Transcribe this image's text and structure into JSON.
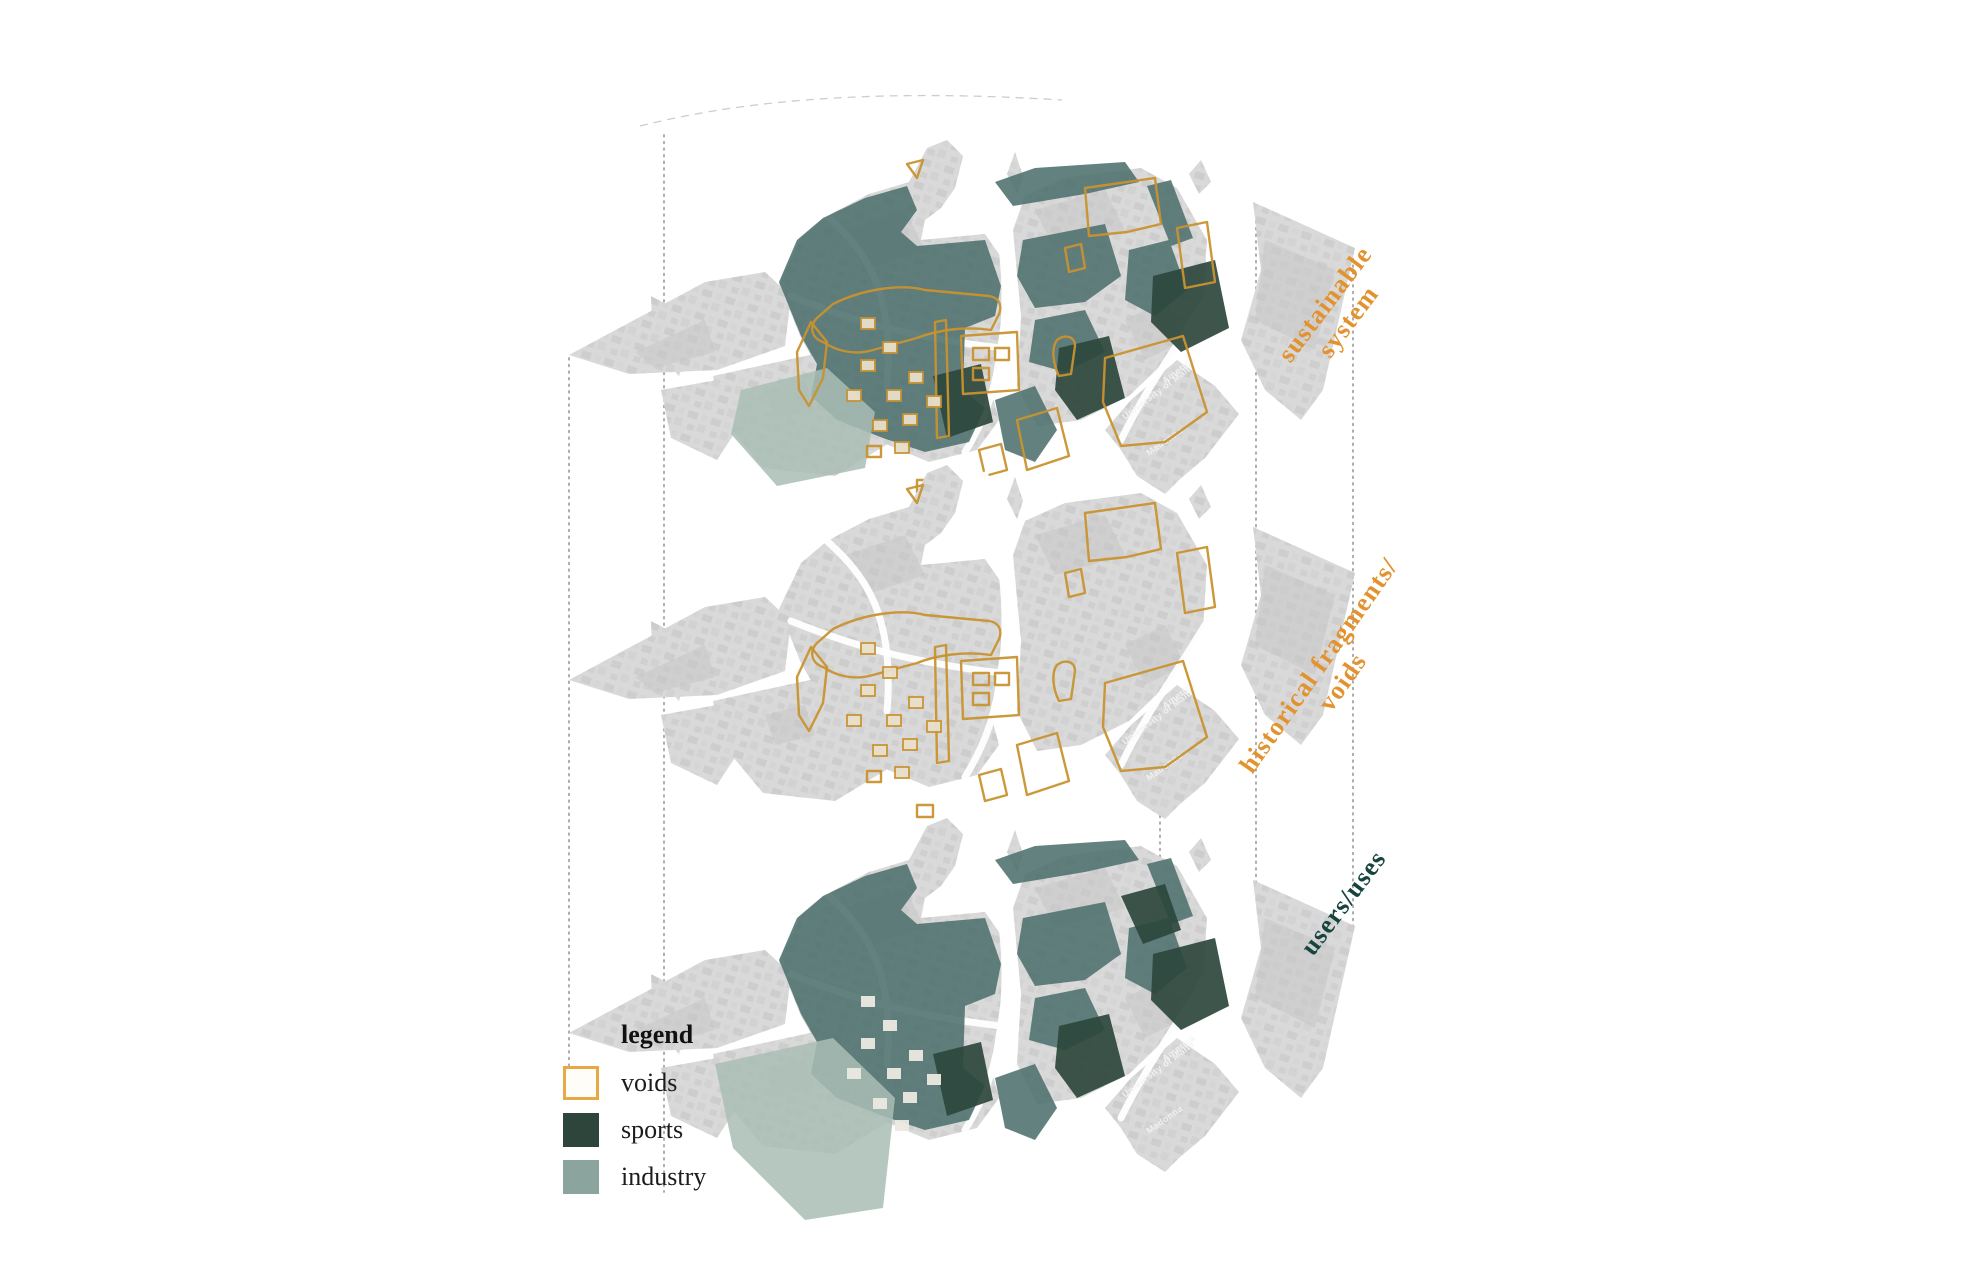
{
  "legend": {
    "heading": "legend",
    "items": [
      {
        "label": "voids",
        "swatch": "white-with-orange-border"
      },
      {
        "label": "sports",
        "swatch": "#2e453b"
      },
      {
        "label": "industry",
        "swatch": "#8ba49e"
      }
    ]
  },
  "layer_labels": {
    "top": {
      "line1": "sustainable",
      "line2": "system",
      "color": "#e2922e"
    },
    "middle": {
      "line1": "historical fragments/",
      "line2": "voids",
      "color": "#e2922e"
    },
    "bottom": {
      "line1": "users/uses",
      "color": "#17453e"
    }
  },
  "aerial_labels": {
    "america": "America",
    "university": "University of Malta",
    "madonna": "Madonna"
  },
  "colors": {
    "orange": "#c8922f",
    "orange-label": "#e2922e",
    "teal": "#4d6f6d",
    "teal-dark": "#2c473c",
    "teal-label": "#17453e",
    "industry": "#a9bdb5",
    "industry-swatch": "#8ba49e",
    "sports-swatch": "#2e453b",
    "land": "#d9d9d9",
    "beige": "#e9e0cb",
    "dots": "#9f9f9f"
  }
}
